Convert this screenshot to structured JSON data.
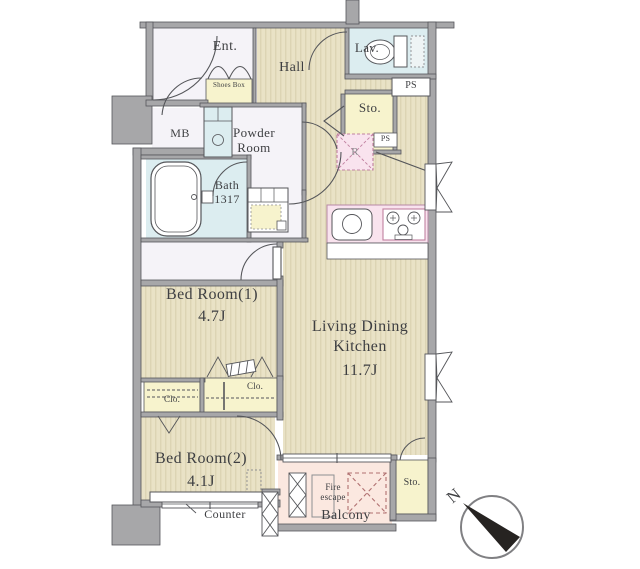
{
  "floorplan": {
    "rooms": {
      "ent": {
        "label": "Ent."
      },
      "hall": {
        "label": "Hall"
      },
      "lav": {
        "label": "Lav."
      },
      "sto_top": {
        "label": "Sto."
      },
      "powder": {
        "label": "Powder Room"
      },
      "bath": {
        "label": "Bath",
        "size": "1317"
      },
      "bedroom1": {
        "label": "Bed Room(1)",
        "size": "4.7J"
      },
      "ldk": {
        "label_line1": "Living Dining",
        "label_line2": "Kitchen",
        "size": "11.7J"
      },
      "bedroom2": {
        "label": "Bed Room(2)",
        "size": "4.1J"
      },
      "balcony": {
        "label": "Balcony"
      },
      "sto_bottom": {
        "label": "Sto."
      }
    },
    "features": {
      "mb": "MB",
      "ps_top": "PS",
      "ps_mid": "PS",
      "shoes_box": "Shoes Box",
      "refrigerator": "R",
      "clo_left": "Clo.",
      "clo_right": "Clo.",
      "counter": "Counter",
      "fire_escape": "Fire escape"
    },
    "compass": {
      "north": "N"
    },
    "colors": {
      "wall": "#a7a7a9",
      "floor": "#e9e2c6",
      "floor_stripe": "#dcd4b4",
      "wet_area": "#dcedf0",
      "storage": "#f7f3cd",
      "kitchen_pink": "#f9e3ee",
      "balcony_peach": "#fbe8e0",
      "room_white": "#f5f3f8",
      "line": "#55565a"
    }
  }
}
